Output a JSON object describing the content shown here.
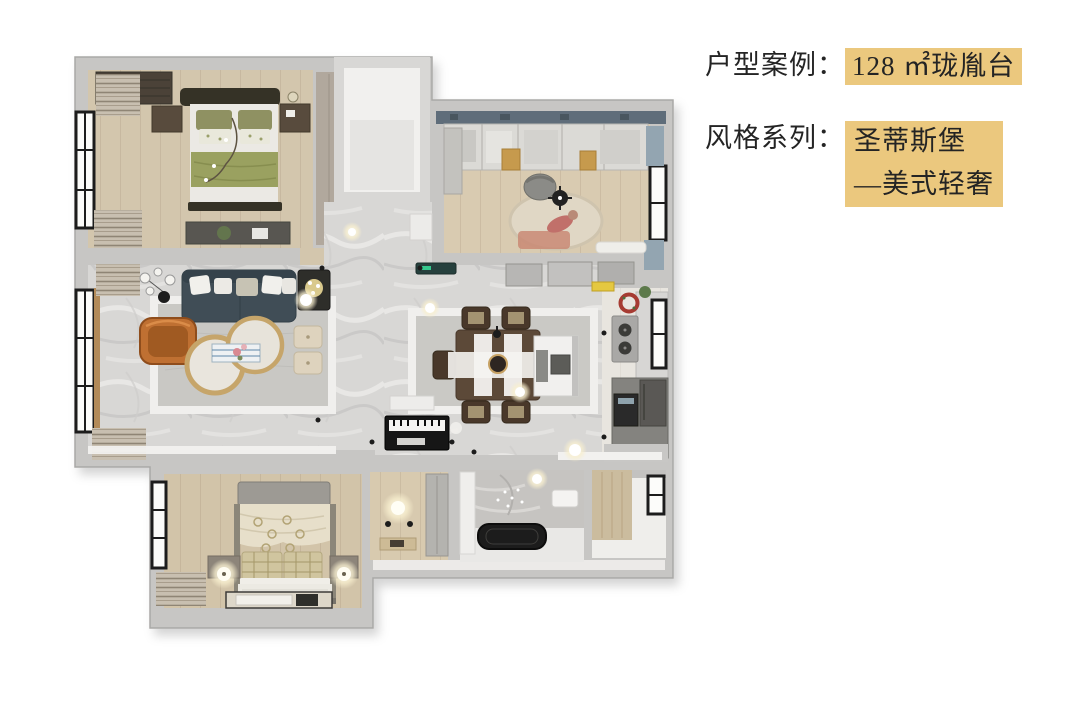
{
  "page": {
    "background_color": "#ffffff"
  },
  "info_panel": {
    "text_color": "#242424",
    "highlight_color": "#ebc87e",
    "case": {
      "label": "户型案例：",
      "value": "128 ㎡珑胤台"
    },
    "style": {
      "label": "风格系列：",
      "value_line1": "圣蒂斯堡",
      "value_line2": "—美式轻奢"
    }
  },
  "floorplan": {
    "type": "3d-top-view-apartment-rendering",
    "area_sqm_from_text": 128,
    "rooms": [
      "master-bedroom",
      "cloakroom",
      "study",
      "entry-hallway",
      "living-room",
      "dining-room",
      "kitchen",
      "second-bedroom",
      "utility-room",
      "bathroom",
      "guest-room"
    ],
    "key_colors": {
      "wall": "#c7c6c4",
      "marble_floor": "#d8d7d5",
      "wood_floor": "#d3c6ad",
      "sofa": "#3f4e57",
      "armchair": "#bf6f30",
      "bedding_olive": "#9aa161",
      "gold_accent": "#c6a56a"
    }
  }
}
